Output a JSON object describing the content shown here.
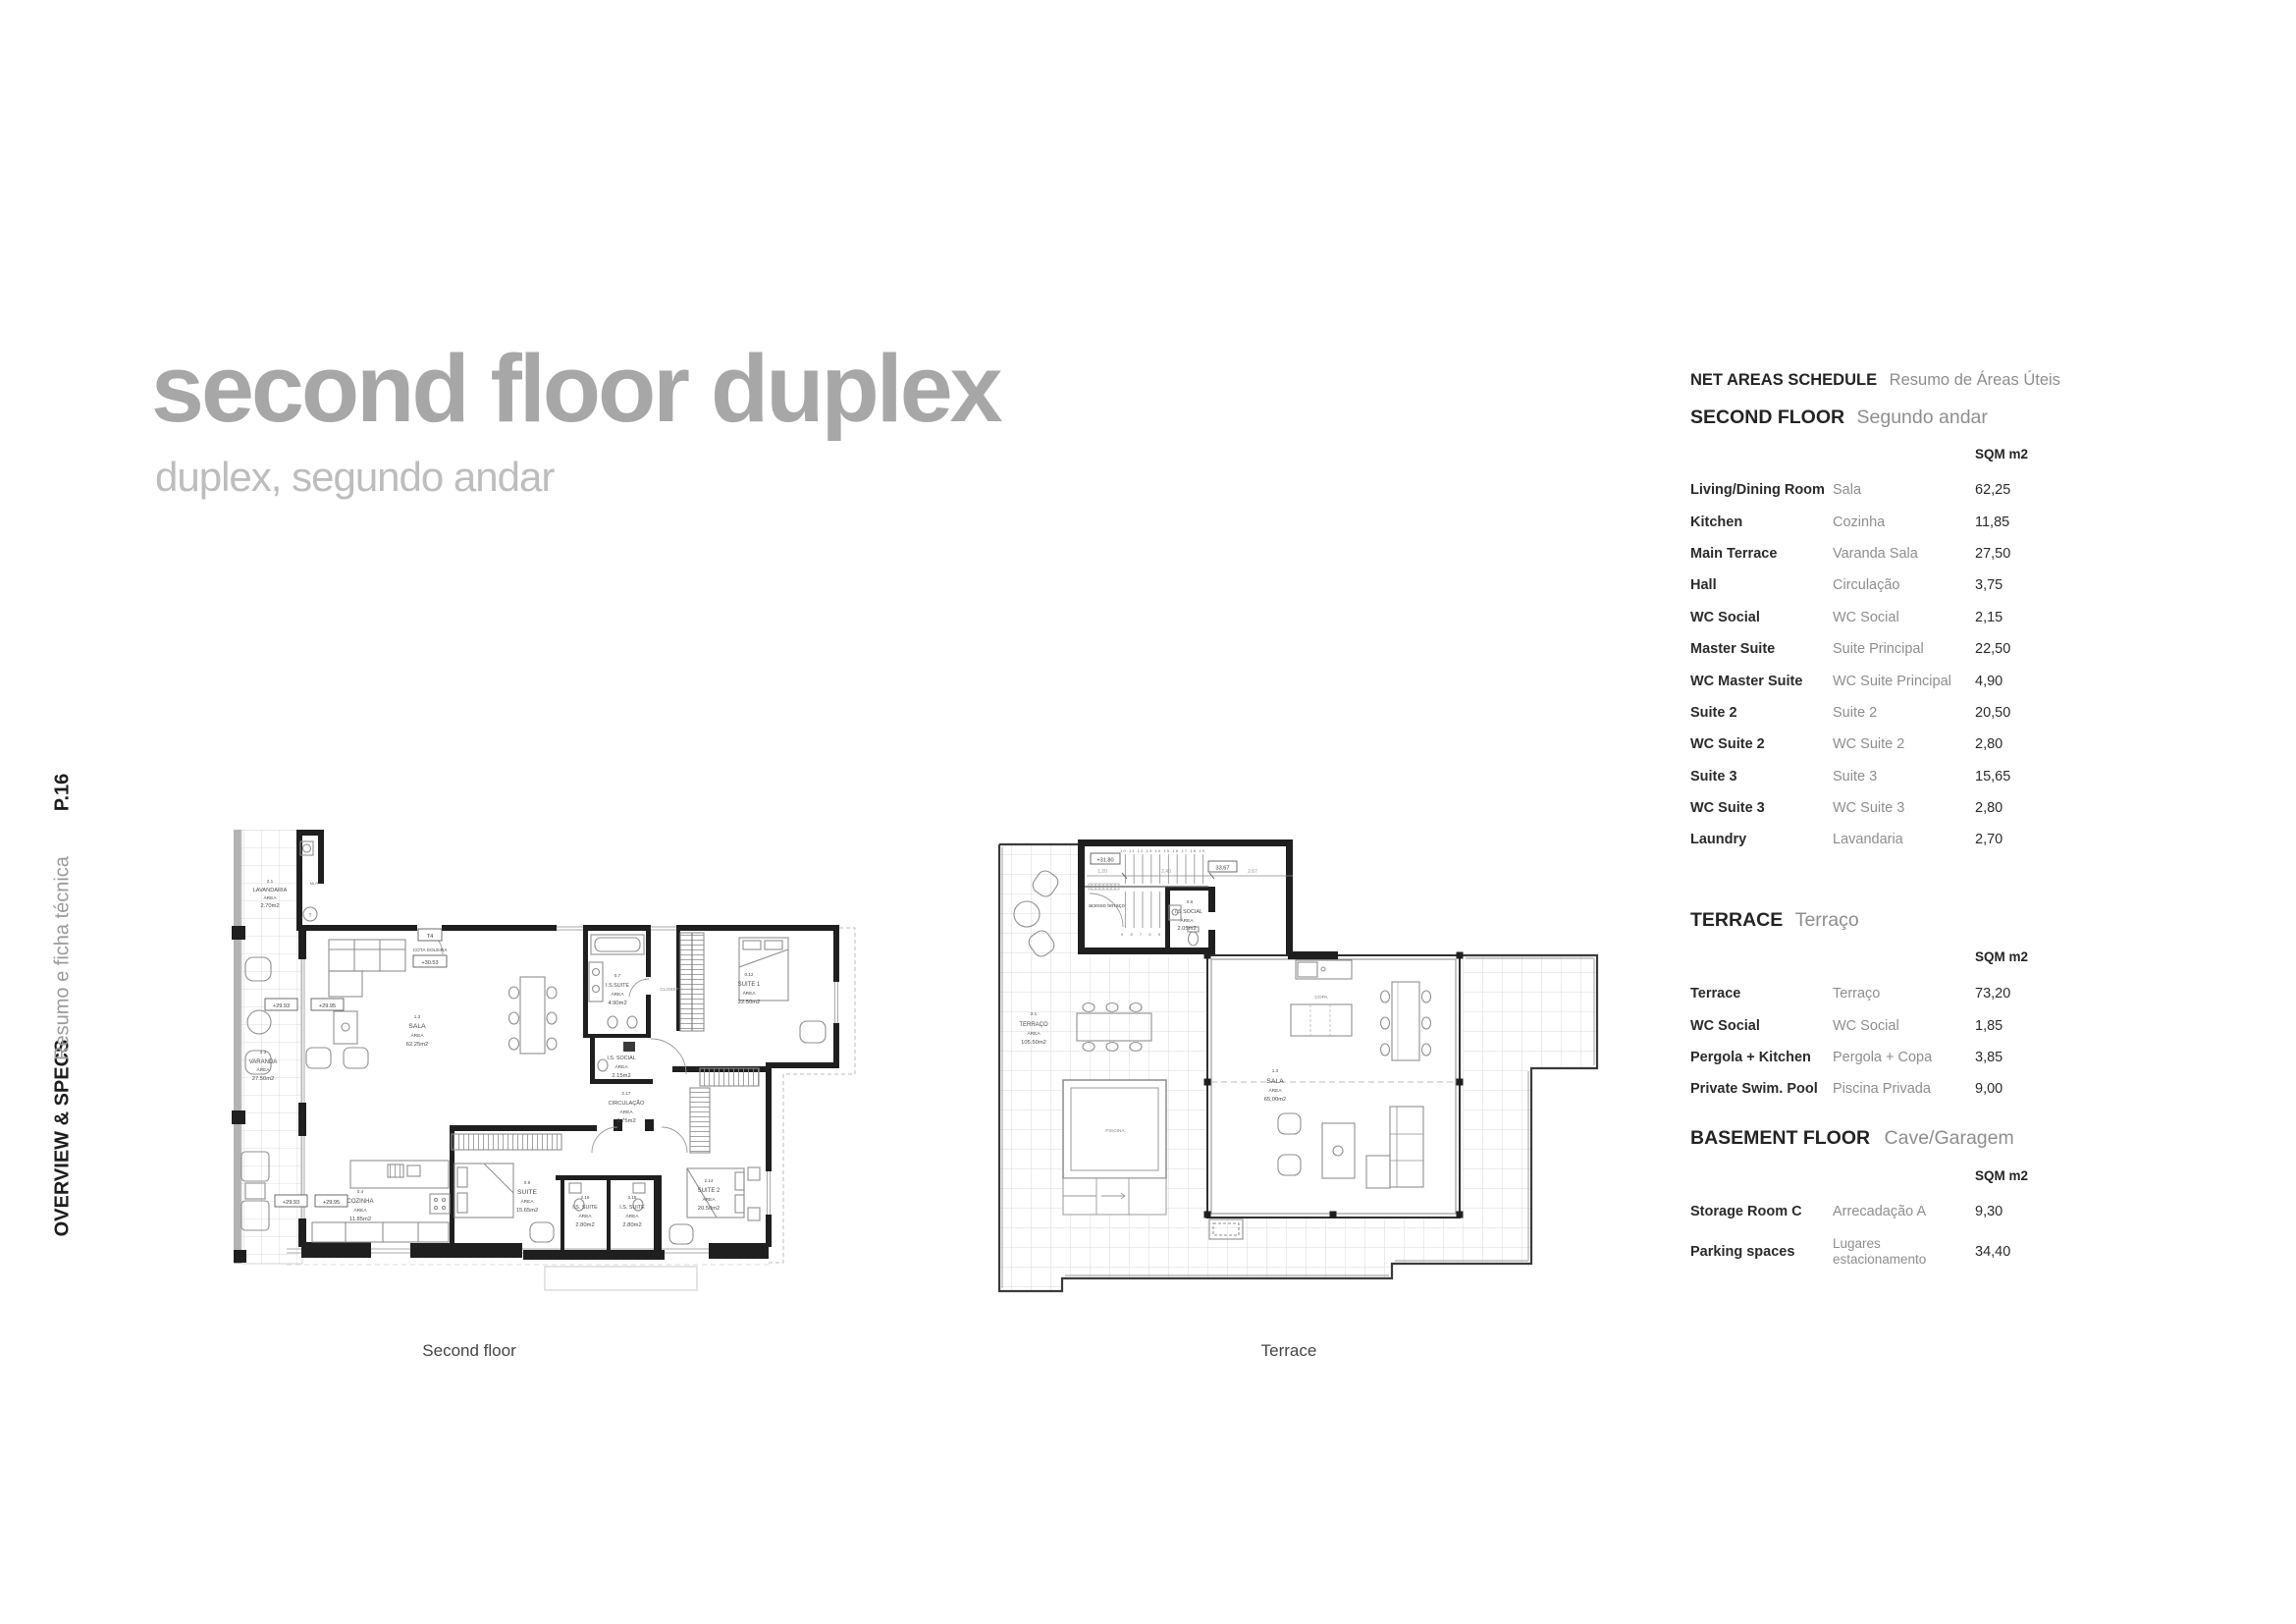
{
  "page": {
    "number": "P.16",
    "section": "OVERVIEW & SPECS",
    "section_sub": "Resumo e ficha técnica"
  },
  "title": {
    "main": "second floor duplex",
    "subtitle": "duplex, segundo andar"
  },
  "schedule": {
    "header_en": "NET AREAS SCHEDULE",
    "header_pt": "Resumo de Áreas Úteis",
    "unit": "SQM m2",
    "sections": [
      {
        "title_en": "SECOND FLOOR",
        "title_pt": "Segundo andar",
        "rows": [
          {
            "en": "Living/Dining Room",
            "pt": "Sala",
            "value": "62,25"
          },
          {
            "en": "Kitchen",
            "pt": "Cozinha",
            "value": "11,85"
          },
          {
            "en": "Main Terrace",
            "pt": "Varanda Sala",
            "value": "27,50"
          },
          {
            "en": "Hall",
            "pt": "Circulação",
            "value": "3,75"
          },
          {
            "en": "WC Social",
            "pt": "WC Social",
            "value": "2,15"
          },
          {
            "en": "Master Suite",
            "pt": "Suite Principal",
            "value": "22,50"
          },
          {
            "en": "WC Master Suite",
            "pt": "WC Suite Principal",
            "value": "4,90"
          },
          {
            "en": "Suite 2",
            "pt": "Suite 2",
            "value": "20,50"
          },
          {
            "en": "WC Suite 2",
            "pt": "WC Suite 2",
            "value": "2,80"
          },
          {
            "en": "Suite 3",
            "pt": "Suite 3",
            "value": "15,65"
          },
          {
            "en": "WC Suite 3",
            "pt": "WC Suite 3",
            "value": "2,80"
          },
          {
            "en": "Laundry",
            "pt": "Lavandaria",
            "value": "2,70"
          }
        ]
      },
      {
        "title_en": "TERRACE",
        "title_pt": "Terraço",
        "rows": [
          {
            "en": "Terrace",
            "pt": "Terraço",
            "value": "73,20"
          },
          {
            "en": "WC Social",
            "pt": "WC Social",
            "value": "1,85"
          },
          {
            "en": "Pergola + Kitchen",
            "pt": "Pergola + Copa",
            "value": "3,85"
          },
          {
            "en": "Private Swim. Pool",
            "pt": "Piscina Privada",
            "value": "9,00"
          }
        ]
      },
      {
        "title_en": "BASEMENT FLOOR",
        "title_pt": "Cave/Garagem",
        "rows": [
          {
            "en": "Storage Room C",
            "pt": "Arrecadação A",
            "value": "9,30"
          },
          {
            "en": "Parking spaces",
            "pt_line1": "Lugares",
            "pt_line2": "estacionamento",
            "value": "34,40"
          }
        ]
      }
    ]
  },
  "plans": {
    "area_word": "ÁREA",
    "second_floor": {
      "caption": "Second floor",
      "rooms": {
        "lavandaria": {
          "num": "2.1",
          "name": "LAVANDARIA",
          "value": "2.70m2"
        },
        "varanda": {
          "num": "2.3",
          "name": "VARANDA",
          "value": "27.50m2"
        },
        "sala": {
          "num": "1.3",
          "name": "SALA",
          "value": "62.25m2"
        },
        "cozinha": {
          "num": "0.4",
          "name": "COZINHA",
          "value": "11.85m2"
        },
        "suite": {
          "num": "0.9",
          "name": "SUITE",
          "value": "15.65m2"
        },
        "is_suite_a": {
          "num": "2.16",
          "name": "I.S. SUITE",
          "value": "2.80m2"
        },
        "is_suite_b": {
          "num": "3.15",
          "name": "I.S. SUITE",
          "value": "2.80m2"
        },
        "suite2": {
          "num": "2.14",
          "name": "SUITE 2",
          "value": "20.50m2"
        },
        "suite1": {
          "num": "0.12",
          "name": "SUITE 1",
          "value": "22.50m2"
        },
        "is_suite_master": {
          "num": "0.7",
          "name": "I.S.SUITE",
          "value": "4.90m2"
        },
        "is_social": {
          "name": "I.S. SOCIAL",
          "value": "2.15m2"
        },
        "circulacao": {
          "num": "2.17",
          "name": "CIRCULAÇÃO",
          "value": "3.75m2"
        }
      },
      "marks": {
        "closet": "CLOSET",
        "t4": "T4",
        "cota": "COTA SOLEIRA",
        "cota_value": "+30.53",
        "level_a": "+29.93",
        "level_b": "+29.95",
        "mlr": "MLR",
        "t": "T"
      }
    },
    "terrace": {
      "caption": "Terrace",
      "rooms": {
        "terraco": {
          "num": "3.1",
          "name": "TERRAÇO",
          "value": "105.50m2"
        },
        "sala": {
          "num": "1.3",
          "name": "SALA",
          "value": "65,00m2"
        },
        "is_social": {
          "num": "0.6",
          "name": "I.S SOCIAL",
          "value": "2.05m2"
        }
      },
      "marks": {
        "piscina": "PISCINA",
        "copa": "COPA",
        "acesso": "acesso terraço",
        "level": "+31.80",
        "dim_total": "33,67",
        "dim_1": "1,20",
        "dim_2": "2,40",
        "dim_3": "2,67",
        "stairs_up": "10 11 12 13 14 15 16 17 18 19",
        "stairs_down": "9 8 7 6 5"
      }
    }
  }
}
